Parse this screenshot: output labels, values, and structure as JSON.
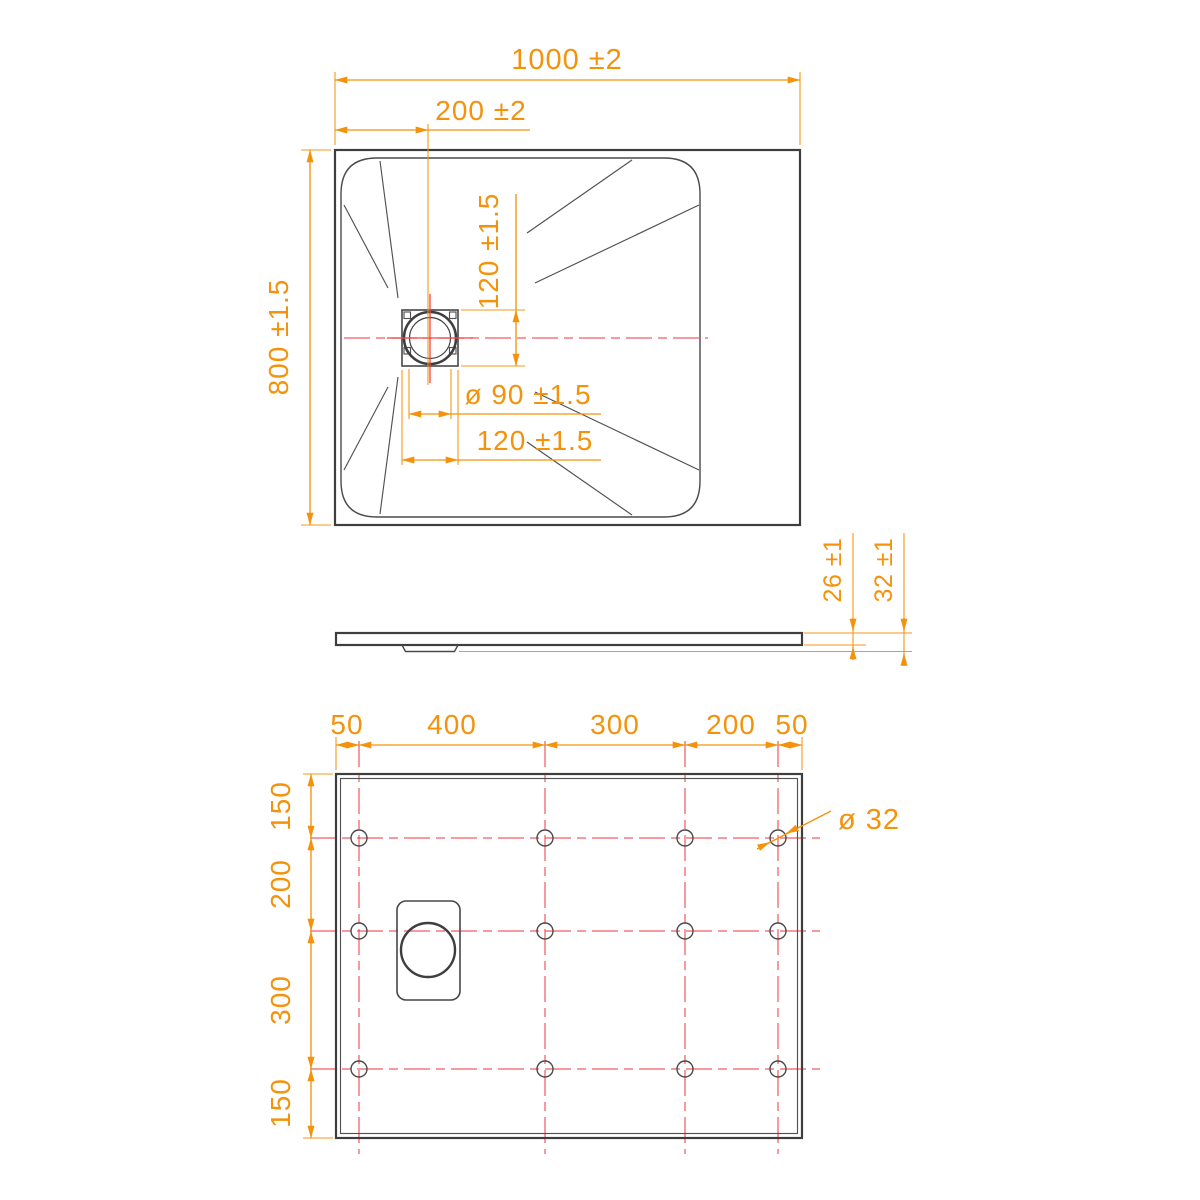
{
  "meta": {
    "type": "technical-drawing",
    "subject": "rectangular shower tray dimensional drawing, three orthographic views",
    "units": "mm",
    "colors": {
      "dimension_accent": "#F5920B",
      "centerline_red": "#EE4348",
      "outline_gray": "#3E3E3E",
      "background": "#FFFFFF"
    }
  },
  "views": {
    "top": {
      "label": "top-view",
      "dimensions": {
        "overall_width": "1000 ±2",
        "drain_offset_x": "200 ±2",
        "overall_depth": "800 ±1.5",
        "drain_square_height": "120 ±1.5",
        "drain_hole_diameter": "ø 90 ±1.5",
        "drain_square_width": "120 ±1.5"
      }
    },
    "side": {
      "label": "side-view",
      "dimensions": {
        "edge_thickness": "26 ±1",
        "overall_thickness": "32 ±1"
      }
    },
    "bottom": {
      "label": "bottom-view",
      "dimensions": {
        "column_spacings": [
          "50",
          "400",
          "300",
          "200",
          "50"
        ],
        "row_spacings": [
          "150",
          "200",
          "300",
          "150"
        ],
        "foot_hole_diameter": "ø 32"
      }
    }
  }
}
